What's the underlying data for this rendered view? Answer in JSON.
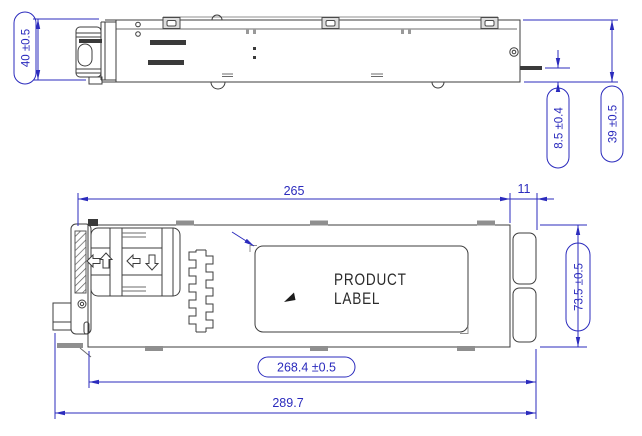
{
  "drawing": {
    "colors": {
      "dimension_blue": "#2b2bbd",
      "line_dark": "#3d3d3d",
      "line_gray": "#8f8f8f",
      "background": "#ffffff"
    },
    "product_label": {
      "line1": "PRODUCT",
      "line2": "LABEL"
    },
    "dimensions": {
      "side_height_left": "40 ±0.5",
      "side_tab_offset": "8.5 ±0.4",
      "side_height_right": "39 ±0.5",
      "plan_body_length": "265",
      "plan_connector_depth": "11",
      "plan_width": "73.5 ±0.5",
      "plan_length_to_connector": "268.4 ±0.5",
      "plan_overall_length": "289.7"
    }
  }
}
